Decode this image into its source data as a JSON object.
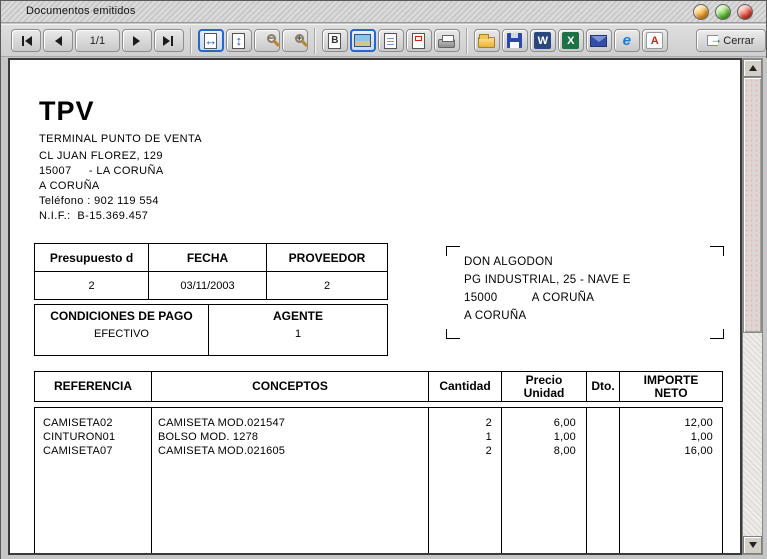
{
  "window": {
    "title": "Documentos emitidos"
  },
  "toolbar": {
    "page_indicator": "1/1",
    "close_label": "Cerrar",
    "icons": [
      "first-page",
      "previous-page",
      "next-page",
      "last-page",
      "fit-width",
      "fit-height",
      "zoom-out",
      "zoom-in",
      "draft-view",
      "graphic-view",
      "text-view",
      "report-view",
      "print",
      "open",
      "save",
      "export-word",
      "export-excel",
      "send-email",
      "export-html",
      "export-pdf",
      "exit-door"
    ],
    "selected_buttons": [
      "fit-width",
      "graphic-view"
    ]
  },
  "colors": {
    "selected_border": "#2a66c8",
    "word_blue": "#29477d",
    "excel_green": "#1e7145",
    "pdf_red": "#c42518",
    "titlebar_button_minimize": "#f2a024",
    "titlebar_button_maximize": "#5dc033",
    "titlebar_button_close": "#e04234"
  },
  "document": {
    "company": {
      "name": "TPV",
      "subtitle": "TERMINAL PUNTO DE VENTA",
      "address1": "CL JUAN FLOREZ, 129",
      "address2": "15007     - LA CORUÑA",
      "address3": "A CORUÑA",
      "phone": "Teléfono : 902 119 554",
      "nif": "N.I.F.:  B-15.369.457"
    },
    "info_table": {
      "headers": [
        "Presupuesto d",
        "FECHA",
        "PROVEEDOR"
      ],
      "values": [
        "2",
        "03/11/2003",
        "2"
      ],
      "headers2": [
        "CONDICIONES DE PAGO",
        "AGENTE"
      ],
      "values2": [
        "EFECTIVO",
        "1"
      ]
    },
    "customer": {
      "line1": "DON ALGODON",
      "line2": "PG INDUSTRIAL, 25 - NAVE E",
      "line3": "15000          A CORUÑA",
      "line4": "A CORUÑA"
    },
    "items_table": {
      "col_referencia": "REFERENCIA",
      "col_conceptos": "CONCEPTOS",
      "col_cantidad": "Cantidad",
      "col_precio_l1": "Precio",
      "col_precio_l2": "Unidad",
      "col_dto": "Dto.",
      "col_importe_l1": "IMPORTE",
      "col_importe_l2": "NETO",
      "rows": [
        {
          "referencia": "CAMISETA02",
          "concepto": "CAMISETA MOD.021547",
          "cantidad": "2",
          "precio": "6,00",
          "dto": "",
          "importe": "12,00"
        },
        {
          "referencia": "CINTURON01",
          "concepto": "BOLSO MOD. 1278",
          "cantidad": "1",
          "precio": "1,00",
          "dto": "",
          "importe": "1,00"
        },
        {
          "referencia": "CAMISETA07",
          "concepto": "CAMISETA MOD.021605",
          "cantidad": "2",
          "precio": "8,00",
          "dto": "",
          "importe": "16,00"
        }
      ]
    }
  }
}
